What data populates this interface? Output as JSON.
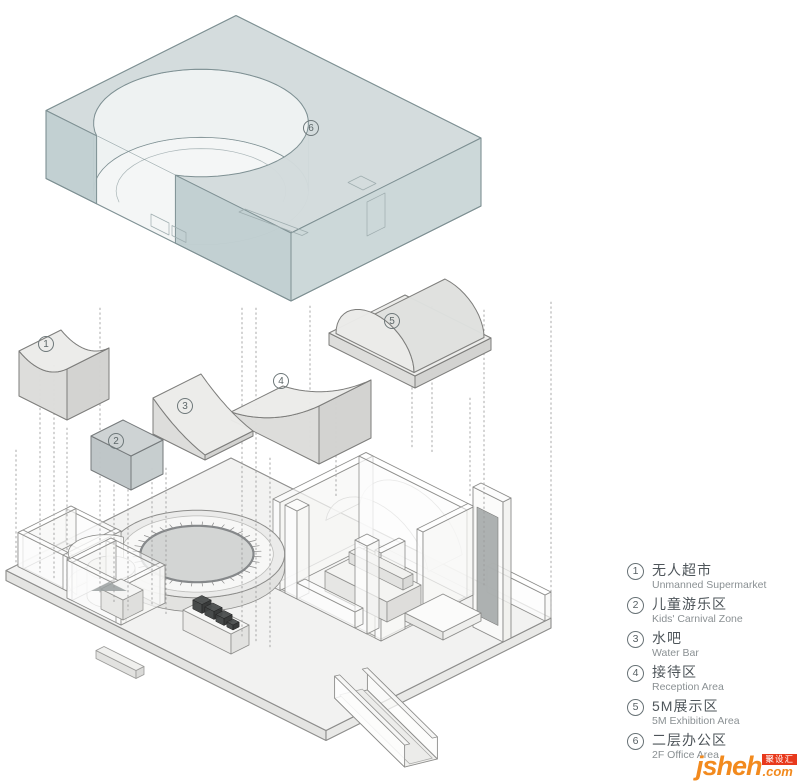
{
  "colors": {
    "background": "#ffffff",
    "slab_top": "#d2dbdc",
    "slab_left": "#c0ced0",
    "slab_right": "#cad6d7",
    "slab_inner": "#edf1f1",
    "slab_floor": "#f3f5f5",
    "slab_stroke": "#7e9093",
    "vol_top": "#ebebe9",
    "vol_left": "#dcdcda",
    "vol_right": "#d2d2d0",
    "vol_stroke": "#7d7d7b",
    "vol2_top": "#ccd2d3",
    "vol2_left": "#bdc4c6",
    "vol2_right": "#c5cccd",
    "ground_stroke": "#8d8d8b",
    "plate_top": "#f2f2f1",
    "plate_side": "#e4e4e2",
    "disc": "#d3d5d4",
    "disc_ring": "#85888a",
    "dark_equipment": "#3e4141",
    "dotted_line": "#9b9b9b",
    "label_color": "#5c6668",
    "legend_zh": "#4e555a",
    "legend_en": "#8a9093",
    "brand_orange": "#f28a1e",
    "badge_red": "#e8391c",
    "badge_text": "#ffffff"
  },
  "diagram": {
    "labels": [
      "1",
      "2",
      "3",
      "4",
      "5",
      "6"
    ]
  },
  "legend": {
    "items": [
      {
        "num": "1",
        "zh": "无人超市",
        "en": "Unmanned Supermarket"
      },
      {
        "num": "2",
        "zh": "儿童游乐区",
        "en": "Kids' Carnival Zone"
      },
      {
        "num": "3",
        "zh": "水吧",
        "en": "Water Bar"
      },
      {
        "num": "4",
        "zh": "接待区",
        "en": "Reception Area"
      },
      {
        "num": "5",
        "zh": "5M展示区",
        "en": "5M Exhibition Area"
      },
      {
        "num": "6",
        "zh": "二层办公区",
        "en": "2F Office Area"
      }
    ]
  },
  "watermark": {
    "brand": "jsheh",
    "tld": ".com",
    "badge": "聚设汇"
  }
}
